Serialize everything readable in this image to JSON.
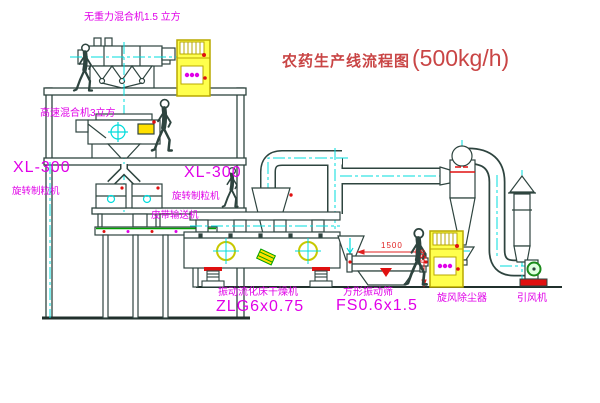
{
  "title": {
    "cn": "农药生产线流程图",
    "capacity": "(500kg/h)"
  },
  "labels": {
    "mixer1": "无重力混合机1.5 立方",
    "mixer2": "高速混合机3立方",
    "granulator1_model": "XL-300",
    "granulator1_name": "旋转制粒机",
    "granulator2_model": "XL-300",
    "granulator2_name": "旋转制粒机",
    "conveyor": "皮带输送机",
    "dryer_name": "振动流化床干燥机",
    "dryer_model": "ZLG6x0.75",
    "sieve_name": "方形振动筛",
    "sieve_model": "FS0.6x1.5",
    "cyclone": "旋风除尘器",
    "fan": "引风机"
  },
  "dimensions": {
    "sieve_width": "1500",
    "sieve_height": "650"
  },
  "colors": {
    "label_magenta": "#e000e8",
    "title_red": "#c94545",
    "accent_red": "#e01010",
    "centerline_cyan": "#00dcdc",
    "cabinet_yellow": "#ffff4d",
    "line_dark": "#2e443f",
    "motor_green": "#00a000"
  }
}
